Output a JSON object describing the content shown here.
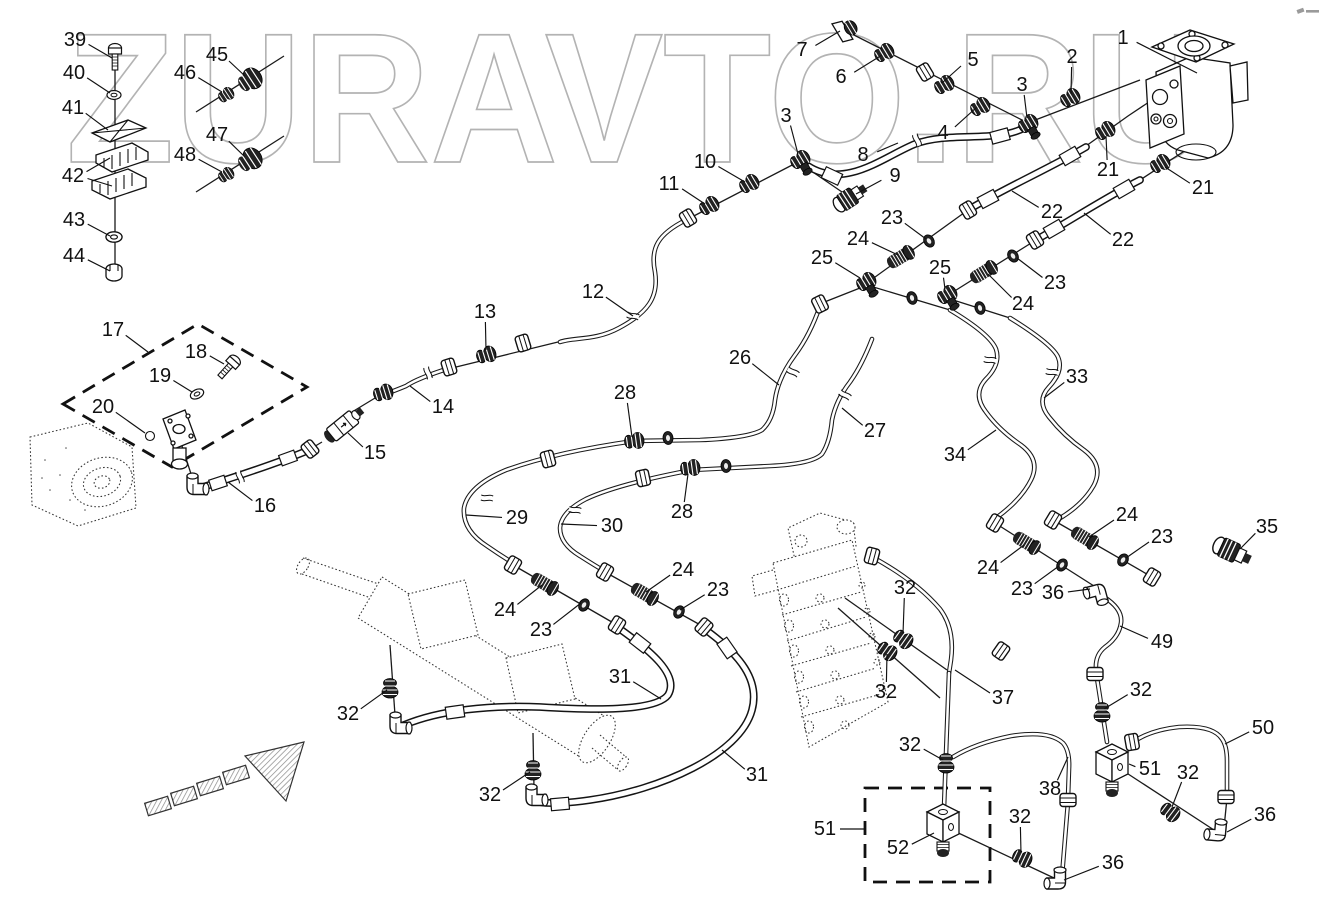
{
  "watermark": {
    "text": "ZURAVTO.RU",
    "color": "#b3b3b3"
  },
  "icons": {
    "corner_mark": "tiny-gray-logo-mark",
    "direction_arrow": "hatched-arrow-up-right"
  },
  "diagram": {
    "style": {
      "line_color": "#1a1a1a",
      "label_font_px": 20
    },
    "callouts": [
      {
        "n": "39",
        "x": 75,
        "y": 40,
        "tx": 112,
        "ty": 58
      },
      {
        "n": "40",
        "x": 74,
        "y": 73,
        "tx": 110,
        "ty": 93
      },
      {
        "n": "41",
        "x": 73,
        "y": 108,
        "tx": 108,
        "ty": 130
      },
      {
        "n": "42",
        "x": 73,
        "y": 176,
        "tx": 110,
        "ty": 158,
        "tx2": 112,
        "ty2": 186
      },
      {
        "n": "43",
        "x": 74,
        "y": 220,
        "tx": 110,
        "ty": 236
      },
      {
        "n": "44",
        "x": 74,
        "y": 256,
        "tx": 110,
        "ty": 271
      },
      {
        "n": "45",
        "x": 217,
        "y": 55,
        "tx": 245,
        "ty": 76
      },
      {
        "n": "46",
        "x": 185,
        "y": 73,
        "tx": 222,
        "ty": 92
      },
      {
        "n": "47",
        "x": 217,
        "y": 135,
        "tx": 245,
        "ty": 157
      },
      {
        "n": "48",
        "x": 185,
        "y": 155,
        "tx": 222,
        "ty": 172
      },
      {
        "n": "17",
        "x": 113,
        "y": 330,
        "tx": 148,
        "ty": 352
      },
      {
        "n": "18",
        "x": 196,
        "y": 352,
        "tx": 224,
        "ty": 364
      },
      {
        "n": "19",
        "x": 160,
        "y": 376,
        "tx": 192,
        "ty": 392
      },
      {
        "n": "20",
        "x": 103,
        "y": 407,
        "tx": 145,
        "ty": 433
      },
      {
        "n": "16",
        "x": 265,
        "y": 506,
        "tx": 228,
        "ty": 482
      },
      {
        "n": "15",
        "x": 375,
        "y": 453,
        "tx": 348,
        "ty": 433
      },
      {
        "n": "14",
        "x": 443,
        "y": 407,
        "tx": 410,
        "ty": 386
      },
      {
        "n": "13",
        "x": 485,
        "y": 312,
        "tx": 486,
        "ty": 350
      },
      {
        "n": "12",
        "x": 593,
        "y": 292,
        "tx": 633,
        "ty": 316
      },
      {
        "n": "11",
        "x": 669,
        "y": 184,
        "tx": 705,
        "ty": 204
      },
      {
        "n": "10",
        "x": 705,
        "y": 162,
        "tx": 745,
        "ty": 182
      },
      {
        "n": "3",
        "x": 786,
        "y": 116,
        "tx": 798,
        "ty": 154
      },
      {
        "n": "9",
        "x": 895,
        "y": 176,
        "tx": 856,
        "ty": 194
      },
      {
        "n": "8",
        "x": 863,
        "y": 155,
        "tx": 898,
        "ty": 143
      },
      {
        "n": "7",
        "x": 802,
        "y": 50,
        "tx": 840,
        "ty": 31
      },
      {
        "n": "6",
        "x": 841,
        "y": 77,
        "tx": 882,
        "ty": 55
      },
      {
        "n": "5",
        "x": 973,
        "y": 60,
        "tx": 942,
        "ty": 83
      },
      {
        "n": "4",
        "x": 943,
        "y": 133,
        "tx": 977,
        "ty": 107
      },
      {
        "n": "3",
        "x": 1022,
        "y": 85,
        "tx": 1027,
        "ty": 118
      },
      {
        "n": "2",
        "x": 1072,
        "y": 57,
        "tx": 1071,
        "ty": 94
      },
      {
        "n": "1",
        "x": 1123,
        "y": 38,
        "tx": 1197,
        "ty": 73
      },
      {
        "n": "21",
        "x": 1108,
        "y": 170,
        "tx": 1106,
        "ty": 136
      },
      {
        "n": "21",
        "x": 1203,
        "y": 188,
        "tx": 1165,
        "ty": 167
      },
      {
        "n": "22",
        "x": 1052,
        "y": 212,
        "tx": 1012,
        "ty": 191
      },
      {
        "n": "22",
        "x": 1123,
        "y": 240,
        "tx": 1084,
        "ty": 213
      },
      {
        "n": "23",
        "x": 892,
        "y": 218,
        "tx": 926,
        "ty": 239
      },
      {
        "n": "24",
        "x": 858,
        "y": 239,
        "tx": 898,
        "ty": 255
      },
      {
        "n": "25",
        "x": 822,
        "y": 258,
        "tx": 860,
        "ty": 278
      },
      {
        "n": "25",
        "x": 940,
        "y": 268,
        "tx": 945,
        "ty": 289
      },
      {
        "n": "23",
        "x": 1055,
        "y": 283,
        "tx": 1017,
        "ty": 258
      },
      {
        "n": "24",
        "x": 1023,
        "y": 304,
        "tx": 988,
        "ty": 274
      },
      {
        "n": "26",
        "x": 740,
        "y": 358,
        "tx": 779,
        "ty": 385
      },
      {
        "n": "27",
        "x": 875,
        "y": 431,
        "tx": 842,
        "ty": 408
      },
      {
        "n": "33",
        "x": 1077,
        "y": 377,
        "tx": 1044,
        "ty": 398
      },
      {
        "n": "34",
        "x": 955,
        "y": 455,
        "tx": 996,
        "ty": 430
      },
      {
        "n": "28",
        "x": 625,
        "y": 393,
        "tx": 632,
        "ty": 437
      },
      {
        "n": "28",
        "x": 682,
        "y": 512,
        "tx": 688,
        "ty": 474
      },
      {
        "n": "29",
        "x": 517,
        "y": 518,
        "tx": 466,
        "ty": 515
      },
      {
        "n": "30",
        "x": 612,
        "y": 526,
        "tx": 561,
        "ty": 524
      },
      {
        "n": "24",
        "x": 505,
        "y": 610,
        "tx": 542,
        "ty": 585
      },
      {
        "n": "23",
        "x": 541,
        "y": 630,
        "tx": 581,
        "ty": 603
      },
      {
        "n": "24",
        "x": 683,
        "y": 570,
        "tx": 646,
        "ty": 592
      },
      {
        "n": "23",
        "x": 718,
        "y": 590,
        "tx": 680,
        "ty": 610
      },
      {
        "n": "31",
        "x": 620,
        "y": 677,
        "tx": 661,
        "ty": 699
      },
      {
        "n": "31",
        "x": 757,
        "y": 775,
        "tx": 722,
        "ty": 750
      },
      {
        "n": "32",
        "x": 348,
        "y": 714,
        "tx": 387,
        "ty": 690
      },
      {
        "n": "32",
        "x": 490,
        "y": 795,
        "tx": 530,
        "ty": 772
      },
      {
        "n": "35",
        "x": 1267,
        "y": 527,
        "tx": 1240,
        "ty": 549
      },
      {
        "n": "24",
        "x": 1127,
        "y": 515,
        "tx": 1089,
        "ty": 537
      },
      {
        "n": "23",
        "x": 1162,
        "y": 537,
        "tx": 1126,
        "ty": 558
      },
      {
        "n": "24",
        "x": 988,
        "y": 568,
        "tx": 1024,
        "ty": 545
      },
      {
        "n": "23",
        "x": 1022,
        "y": 589,
        "tx": 1059,
        "ty": 566
      },
      {
        "n": "36",
        "x": 1053,
        "y": 593,
        "tx": 1090,
        "ty": 589
      },
      {
        "n": "49",
        "x": 1162,
        "y": 642,
        "tx": 1120,
        "ty": 626
      },
      {
        "n": "32",
        "x": 1141,
        "y": 690,
        "tx": 1104,
        "ty": 709
      },
      {
        "n": "50",
        "x": 1263,
        "y": 728,
        "tx": 1225,
        "ty": 744
      },
      {
        "n": "51",
        "x": 1150,
        "y": 769,
        "tx": 1129,
        "ty": 764
      },
      {
        "n": "32",
        "x": 1188,
        "y": 773,
        "tx": 1172,
        "ty": 807
      },
      {
        "n": "36",
        "x": 1265,
        "y": 815,
        "tx": 1227,
        "ty": 832
      },
      {
        "n": "32",
        "x": 905,
        "y": 588,
        "tx": 903,
        "ty": 634
      },
      {
        "n": "32",
        "x": 886,
        "y": 692,
        "tx": 887,
        "ty": 654
      },
      {
        "n": "37",
        "x": 1003,
        "y": 698,
        "tx": 955,
        "ty": 670
      },
      {
        "n": "38",
        "x": 1050,
        "y": 789,
        "tx": 1068,
        "ty": 757
      },
      {
        "n": "32",
        "x": 910,
        "y": 745,
        "tx": 943,
        "ty": 760
      },
      {
        "n": "51",
        "x": 825,
        "y": 829,
        "tx": 864,
        "ty": 829
      },
      {
        "n": "52",
        "x": 898,
        "y": 848,
        "tx": 934,
        "ty": 833
      },
      {
        "n": "32",
        "x": 1020,
        "y": 817,
        "tx": 1021,
        "ty": 853
      },
      {
        "n": "36",
        "x": 1113,
        "y": 863,
        "tx": 1064,
        "ty": 880
      }
    ]
  }
}
